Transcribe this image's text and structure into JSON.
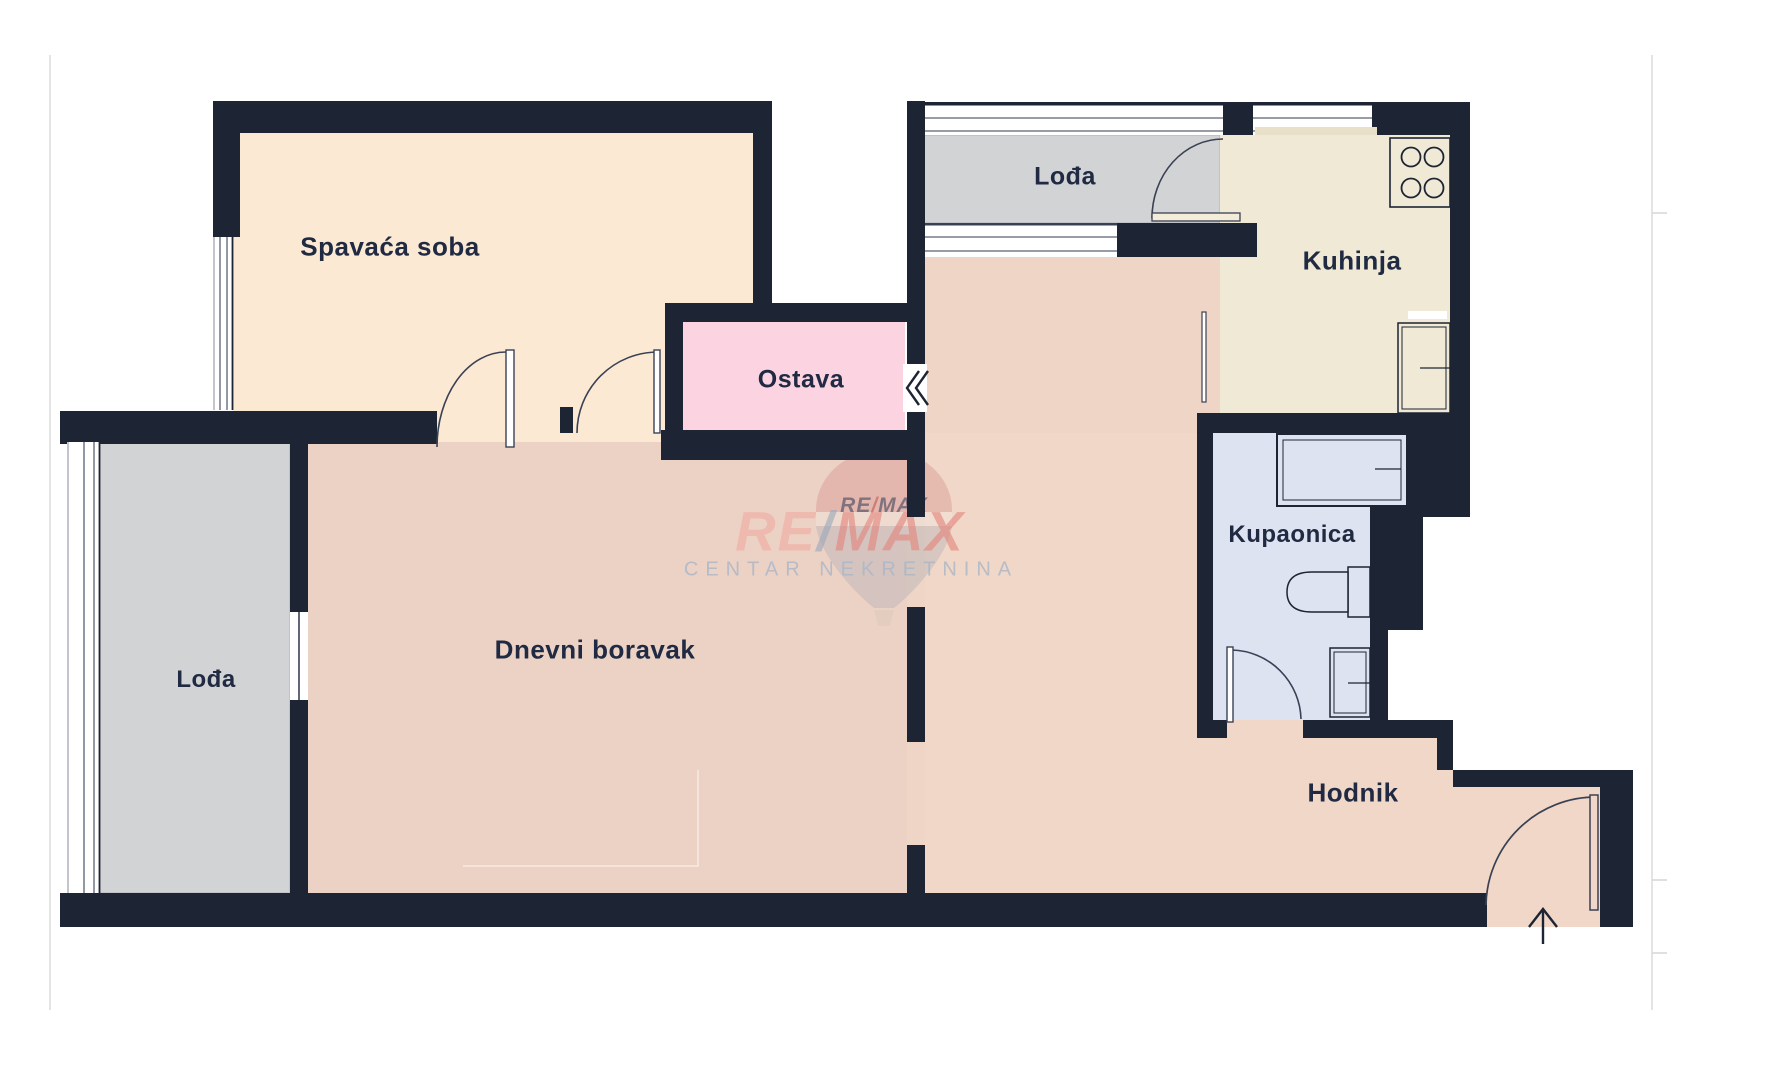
{
  "rooms": {
    "spavaca_soba": {
      "label": "Spavaća soba"
    },
    "loda_top": {
      "label": "Lođa"
    },
    "kuhinja": {
      "label": "Kuhinja"
    },
    "ostava": {
      "label": "Ostava"
    },
    "kupaonica": {
      "label": "Kupaonica"
    },
    "loda_left": {
      "label": "Lođa"
    },
    "dnevni_boravak": {
      "label": "Dnevni boravak"
    },
    "hodnik": {
      "label": "Hodnik"
    }
  },
  "watermark": {
    "small_re": "RE",
    "small_slash": "/",
    "small_max": "MAX",
    "big_re": "RE",
    "big_slash": "/",
    "big_max": "MAX",
    "subtitle": "CENTAR NEKRETNINA"
  },
  "palette": {
    "wall": "#1d2433",
    "bedroom_floor": "#fbe9d3",
    "living_floor": "#ecd2c4",
    "corridor_floor": "#f0d7c7",
    "ostava_floor": "#fcd4e1",
    "loggia_floor": "#d2d3d5",
    "kitchen_floor": "#efe9d5",
    "bathroom_floor": "#dde3f0",
    "label_text": "#202a42",
    "watermark_red": "#e4837a",
    "watermark_pink": "#f0a9a2",
    "watermark_slash": "#9aa7bb",
    "watermark_subtitle": "#a9b6c8"
  }
}
